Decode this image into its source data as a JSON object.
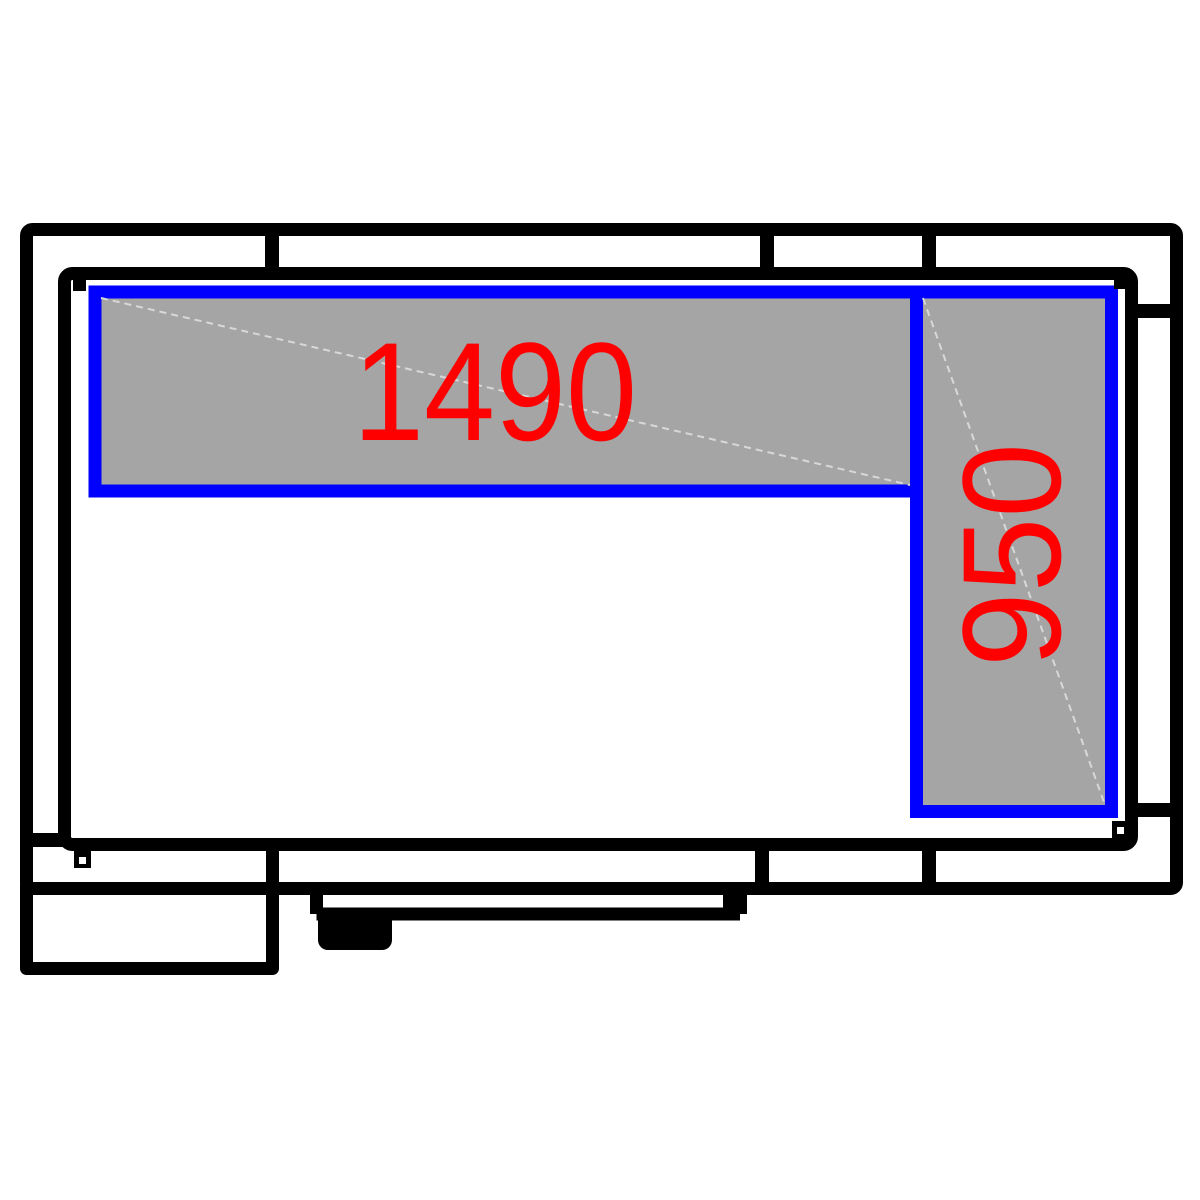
{
  "diagram": {
    "kind": "cold-room-floor-plan",
    "dimension_labels": {
      "shelf_top": "1490",
      "shelf_right": "950"
    },
    "colors": {
      "background": "#ffffff",
      "wall": "#000000",
      "shelf_border": "#0000ff",
      "shelf_fill": "#a5a5a5",
      "dimension_text": "#ff0000",
      "shelf_diagonal": "#d8d8d8"
    }
  }
}
